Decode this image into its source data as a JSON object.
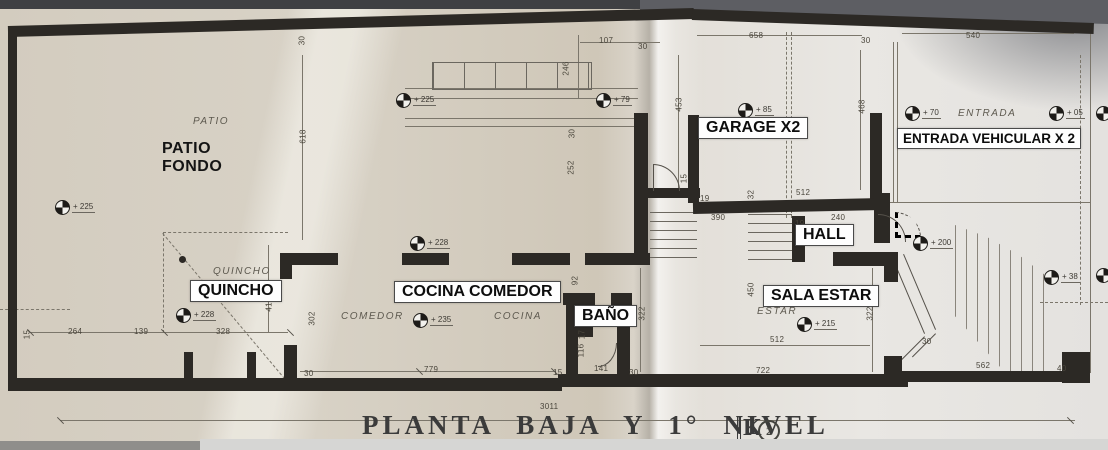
{
  "title": {
    "text": "PLANTA BAJA Y 1° NIVEL",
    "sheet_number": "2"
  },
  "overlay": {
    "patio_fondo_line1": "PATIO",
    "patio_fondo_line2": "FONDO"
  },
  "room_labels": [
    {
      "text": "QUINCHO",
      "name": "room-label-quincho",
      "x": 190,
      "y": 280
    },
    {
      "text": "COCINA COMEDOR",
      "name": "room-label-cocina-comedor",
      "x": 394,
      "y": 281
    },
    {
      "text": "BAÑO",
      "name": "room-label-bano",
      "x": 574,
      "y": 305
    },
    {
      "text": "GARAGE  X2",
      "name": "room-label-garage",
      "x": 698,
      "y": 117
    },
    {
      "text": "HALL",
      "name": "room-label-hall",
      "x": 795,
      "y": 224
    },
    {
      "text": "SALA ESTAR",
      "name": "room-label-sala-estar",
      "x": 763,
      "y": 285
    },
    {
      "text": "ENTRADA VEHICULAR X 2",
      "name": "room-label-entrada-vehicular",
      "x": 897,
      "y": 128,
      "cls": "small"
    }
  ],
  "plan_texts": [
    {
      "text": "PATIO",
      "name": "plan-text-patio",
      "x": 193,
      "y": 116
    },
    {
      "text": "QUINCHO",
      "name": "plan-text-quincho",
      "x": 213,
      "y": 266
    },
    {
      "text": "COMEDOR",
      "name": "plan-text-comedor",
      "x": 341,
      "y": 311
    },
    {
      "text": "COCINA",
      "name": "plan-text-cocina",
      "x": 494,
      "y": 311
    },
    {
      "text": "ESTAR",
      "name": "plan-text-estar",
      "x": 757,
      "y": 306
    },
    {
      "text": "ENTRADA",
      "name": "plan-text-entrada",
      "x": 958,
      "y": 108
    }
  ],
  "level_markers": [
    {
      "text": "+ 225",
      "x": 55,
      "y": 200
    },
    {
      "text": "+ 225",
      "x": 396,
      "y": 93
    },
    {
      "text": "+ 79",
      "x": 596,
      "y": 93
    },
    {
      "text": "+ 85",
      "x": 738,
      "y": 103
    },
    {
      "text": "+ 70",
      "x": 905,
      "y": 106
    },
    {
      "text": "+ 05",
      "x": 1049,
      "y": 106
    },
    {
      "text": "",
      "x": 1096,
      "y": 106
    },
    {
      "text": "+ 228",
      "x": 410,
      "y": 236
    },
    {
      "text": "+ 228",
      "x": 176,
      "y": 308
    },
    {
      "text": "+ 235",
      "x": 413,
      "y": 313
    },
    {
      "text": "+ 215",
      "x": 797,
      "y": 317
    },
    {
      "text": "+ 200",
      "x": 913,
      "y": 236
    },
    {
      "text": "+ 38",
      "x": 1044,
      "y": 270
    },
    {
      "text": "",
      "x": 1096,
      "y": 268
    }
  ],
  "dimensions": [
    {
      "text": "107",
      "x": 599,
      "y": 36
    },
    {
      "text": "30",
      "x": 638,
      "y": 42
    },
    {
      "text": "658",
      "x": 749,
      "y": 31
    },
    {
      "text": "30",
      "x": 861,
      "y": 36
    },
    {
      "text": "540",
      "x": 966,
      "y": 31
    },
    {
      "text": "390",
      "x": 711,
      "y": 213
    },
    {
      "text": "512",
      "x": 796,
      "y": 188
    },
    {
      "text": "240",
      "x": 831,
      "y": 213
    },
    {
      "text": "19",
      "x": 795,
      "y": 219
    },
    {
      "text": "19",
      "x": 700,
      "y": 194
    },
    {
      "text": "512",
      "x": 770,
      "y": 335
    },
    {
      "text": "722",
      "x": 756,
      "y": 366
    },
    {
      "text": "264",
      "x": 68,
      "y": 327
    },
    {
      "text": "139",
      "x": 134,
      "y": 327
    },
    {
      "text": "328",
      "x": 216,
      "y": 327
    },
    {
      "text": "779",
      "x": 424,
      "y": 365
    },
    {
      "text": "141",
      "x": 594,
      "y": 364
    },
    {
      "text": "15",
      "x": 553,
      "y": 368
    },
    {
      "text": "30",
      "x": 629,
      "y": 368
    },
    {
      "text": "30",
      "x": 304,
      "y": 369
    },
    {
      "text": "562",
      "x": 976,
      "y": 361
    },
    {
      "text": "40",
      "x": 1057,
      "y": 364
    },
    {
      "text": "30",
      "x": 922,
      "y": 337
    },
    {
      "text": "3011",
      "x": 540,
      "y": 402
    },
    {
      "text": "618",
      "x": 296,
      "y": 132,
      "rot": true
    },
    {
      "text": "30",
      "x": 297,
      "y": 36,
      "rot": true
    },
    {
      "text": "246",
      "x": 559,
      "y": 64,
      "rot": true
    },
    {
      "text": "453",
      "x": 672,
      "y": 100,
      "rot": true
    },
    {
      "text": "468",
      "x": 855,
      "y": 102,
      "rot": true
    },
    {
      "text": "252",
      "x": 564,
      "y": 163,
      "rot": true
    },
    {
      "text": "30",
      "x": 567,
      "y": 129,
      "rot": true
    },
    {
      "text": "15",
      "x": 679,
      "y": 174,
      "rot": true
    },
    {
      "text": "32",
      "x": 746,
      "y": 190,
      "rot": true
    },
    {
      "text": "450",
      "x": 744,
      "y": 285,
      "rot": true
    },
    {
      "text": "322",
      "x": 635,
      "y": 309,
      "rot": true
    },
    {
      "text": "322",
      "x": 863,
      "y": 309,
      "rot": true
    },
    {
      "text": "412",
      "x": 262,
      "y": 300,
      "rot": true
    },
    {
      "text": "302",
      "x": 305,
      "y": 314,
      "rot": true
    },
    {
      "text": "15",
      "x": 22,
      "y": 330,
      "rot": true
    },
    {
      "text": "116",
      "x": 574,
      "y": 346,
      "rot": true
    },
    {
      "text": "17",
      "x": 577,
      "y": 330,
      "rot": true
    },
    {
      "text": "92",
      "x": 570,
      "y": 276,
      "rot": true
    }
  ],
  "colors": {
    "paper_warm": "#d3ccbf",
    "paper_light": "#e9e7e3",
    "wall": "#2c2925",
    "label_background": "#fefefe",
    "label_text": "#0d0d0d",
    "top_band": "#3f4043"
  }
}
